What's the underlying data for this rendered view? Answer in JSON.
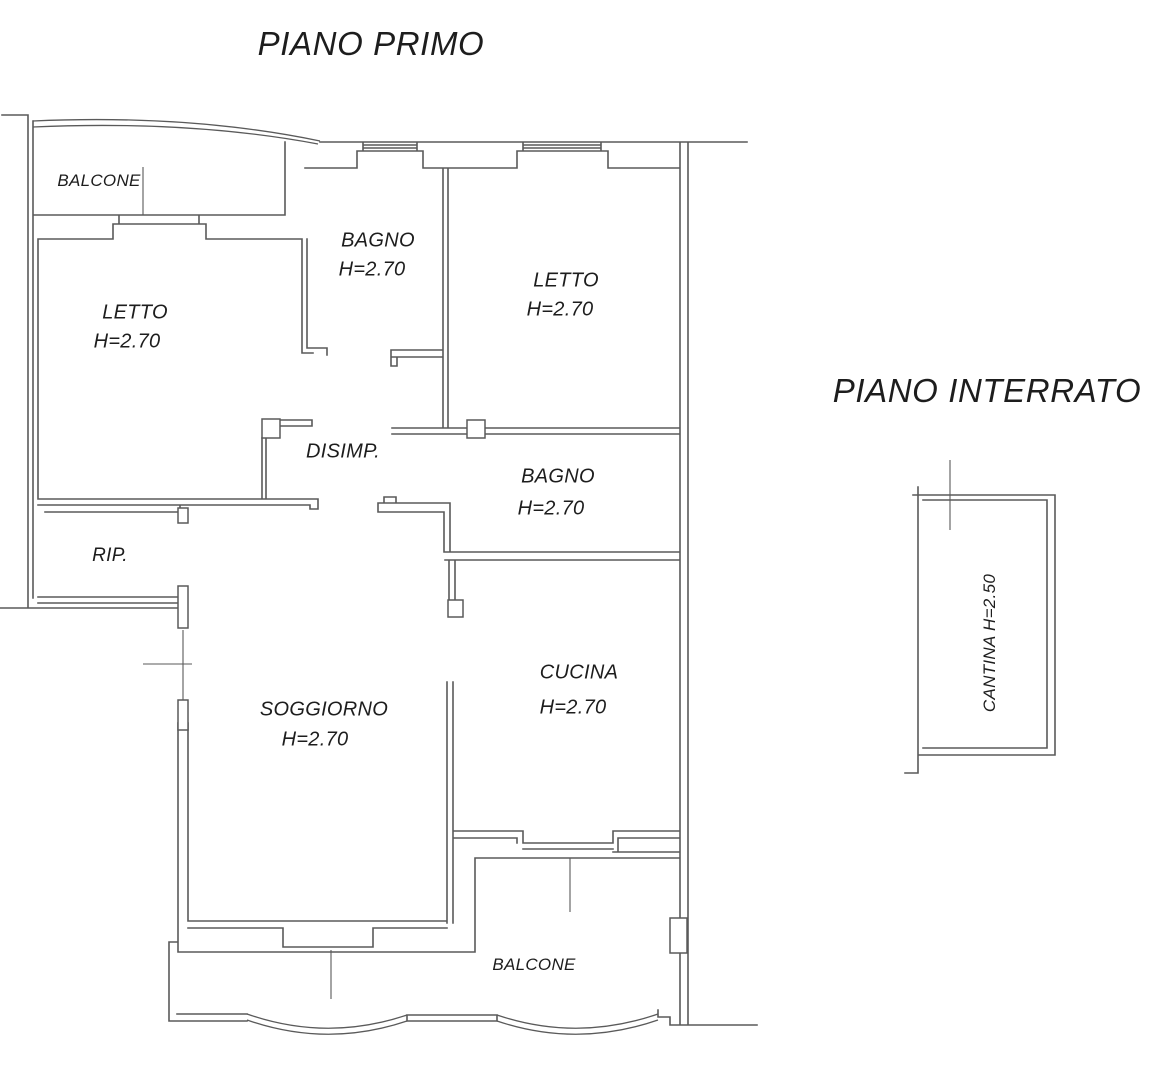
{
  "colors": {
    "background": "#ffffff",
    "wall": "#5a5a5a",
    "text": "#1d1d1d"
  },
  "floors": {
    "piano_primo": {
      "title": "PIANO PRIMO",
      "rooms": {
        "balcone_top": {
          "label": "BALCONE"
        },
        "letto_sx": {
          "label": "LETTO",
          "height": "H=2.70"
        },
        "bagno_top": {
          "label": "BAGNO",
          "height": "H=2.70"
        },
        "letto_dx": {
          "label": "LETTO",
          "height": "H=2.70"
        },
        "disimpegno": {
          "label": "DISIMP."
        },
        "bagno_centro": {
          "label": "BAGNO",
          "height": "H=2.70"
        },
        "ripostiglio": {
          "label": "RIP."
        },
        "soggiorno": {
          "label": "SOGGIORNO",
          "height": "H=2.70"
        },
        "cucina": {
          "label": "CUCINA",
          "height": "H=2.70"
        },
        "balcone_basso": {
          "label": "BALCONE"
        }
      }
    },
    "piano_interrato": {
      "title": "PIANO INTERRATO",
      "rooms": {
        "cantina": {
          "label": "CANTINA H=2.50"
        }
      }
    }
  }
}
